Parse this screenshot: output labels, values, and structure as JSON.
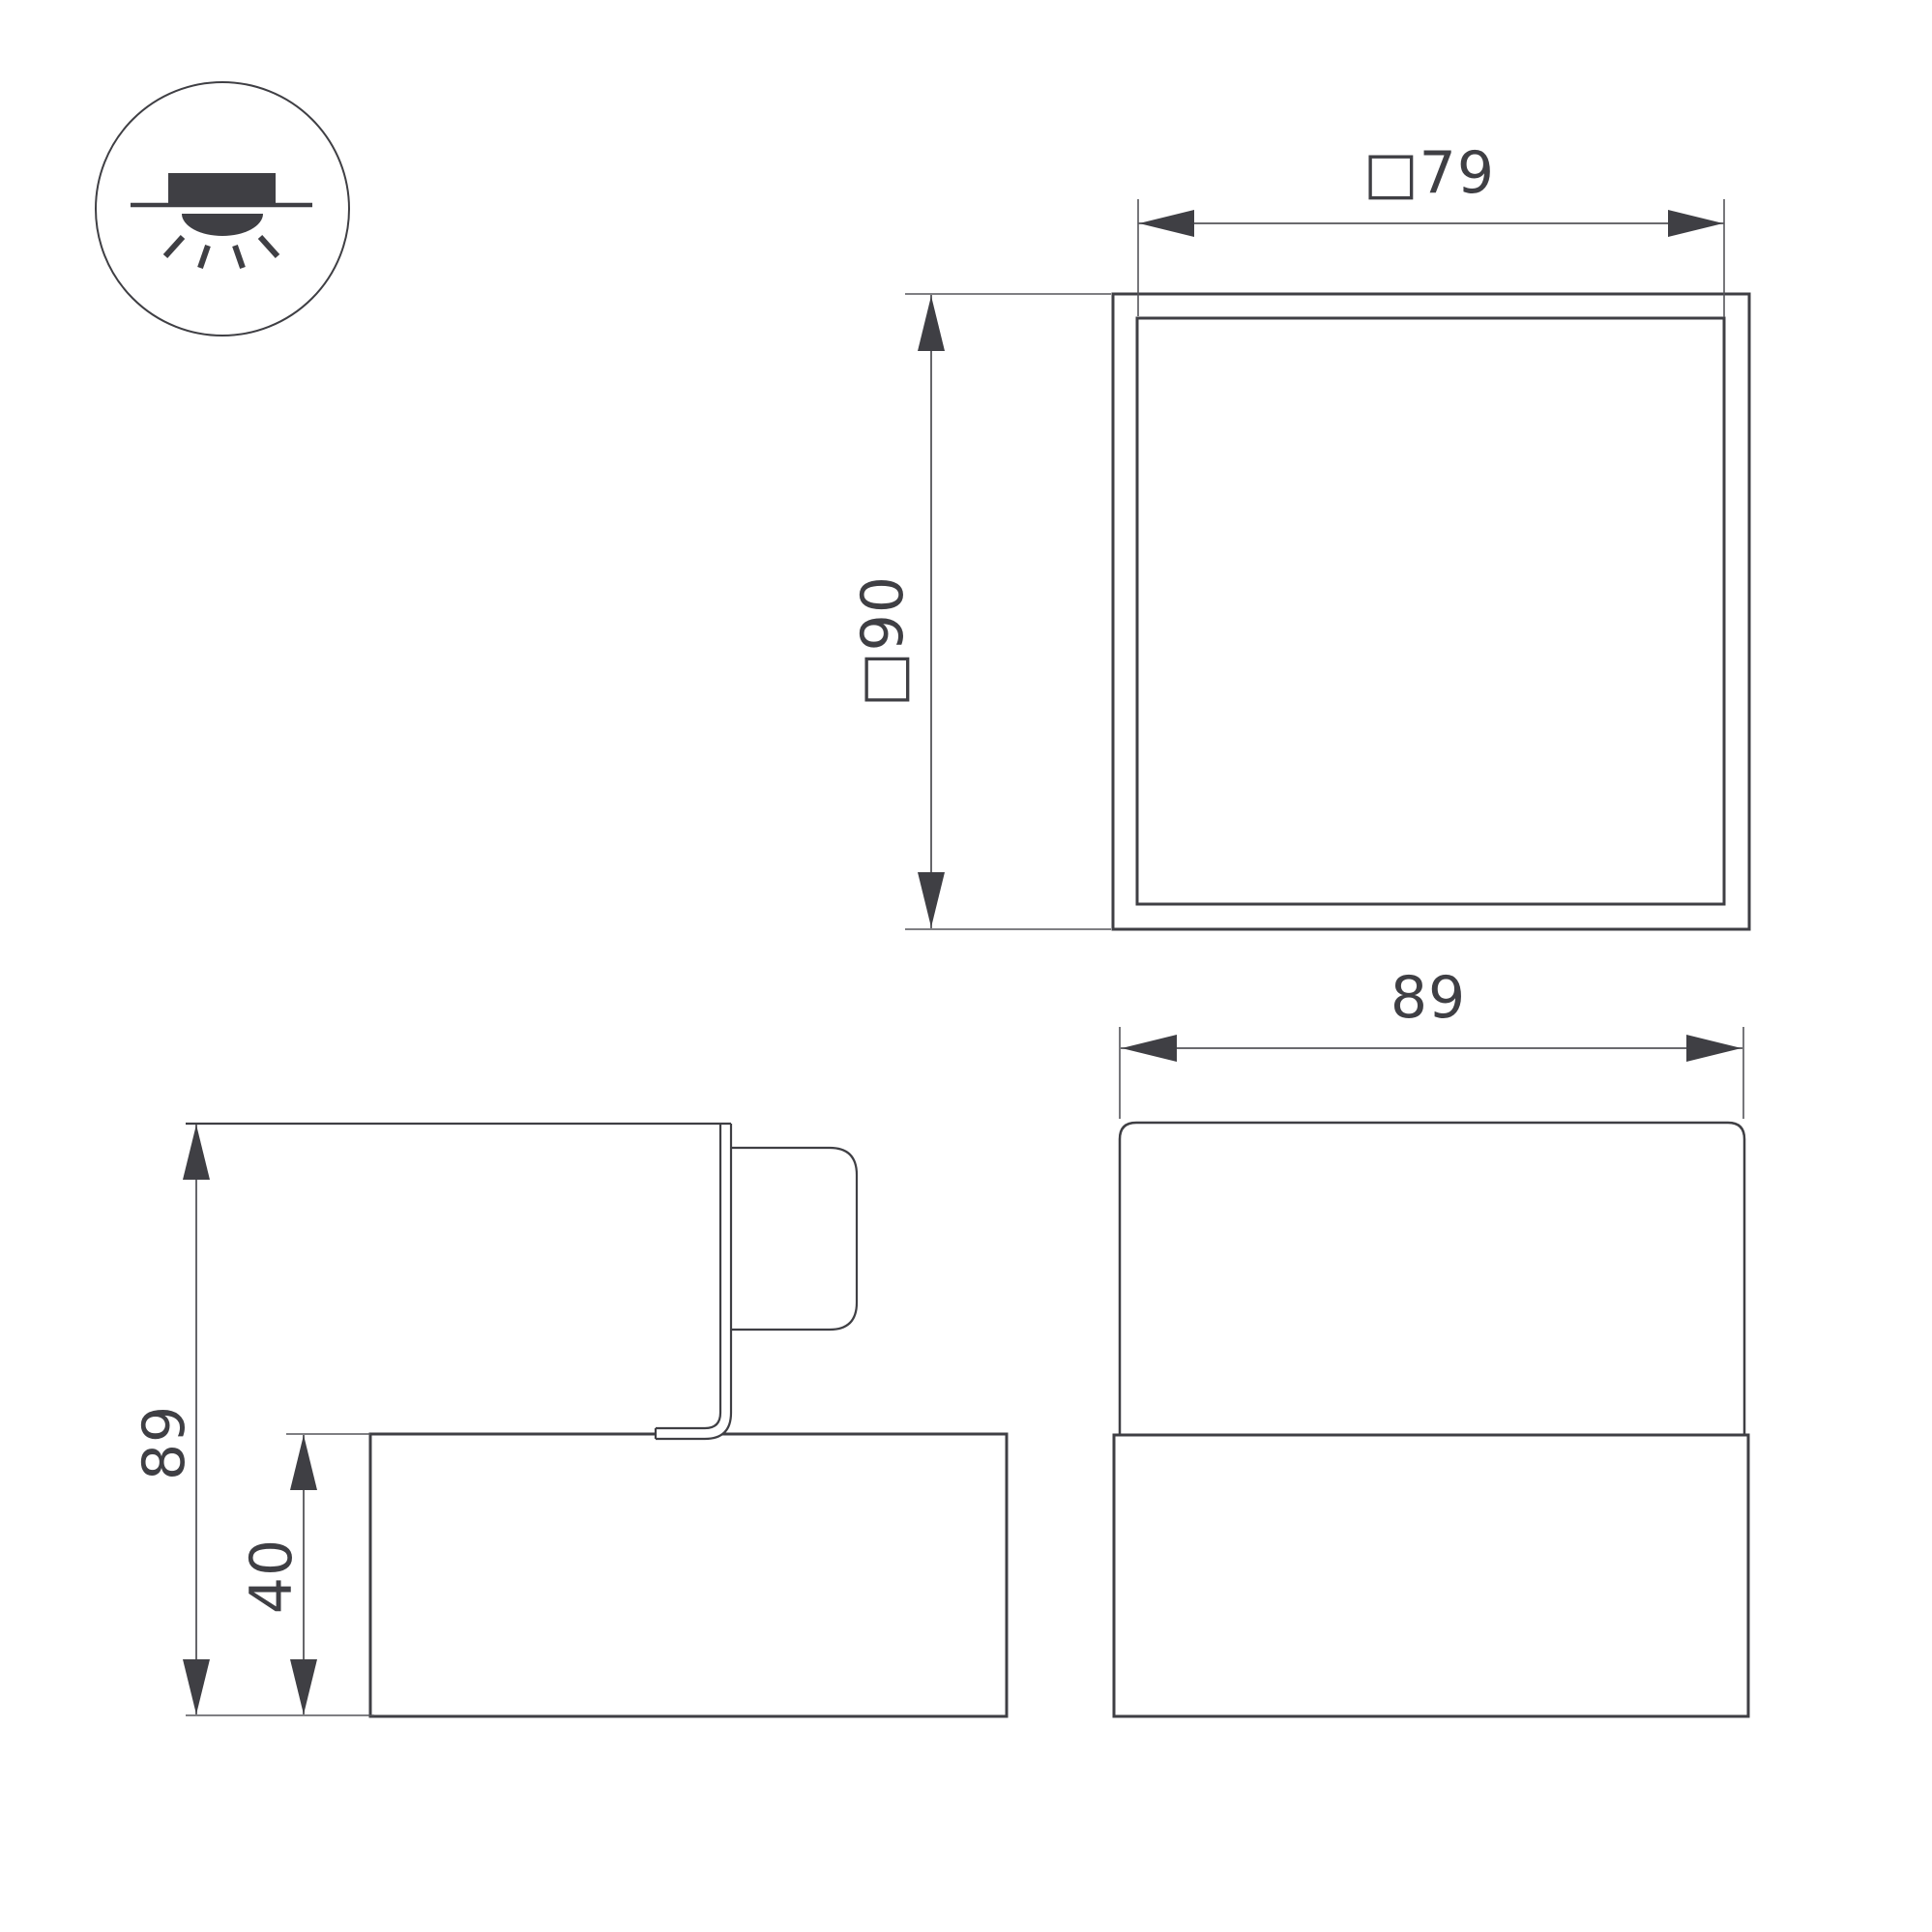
{
  "page": {
    "background": "#ffffff",
    "outline_color": "#3f3f44",
    "dimension_line_color": "#55555a",
    "text_color": "#3f3f44"
  },
  "icon": {
    "meaning": "surface-mounted-downlight"
  },
  "plan_view": {
    "inner_width_label": "□79",
    "outer_height_label": "□90"
  },
  "side_view": {
    "total_height_label": "89",
    "body_height_label": "40"
  },
  "front_view": {
    "width_label": "89"
  }
}
